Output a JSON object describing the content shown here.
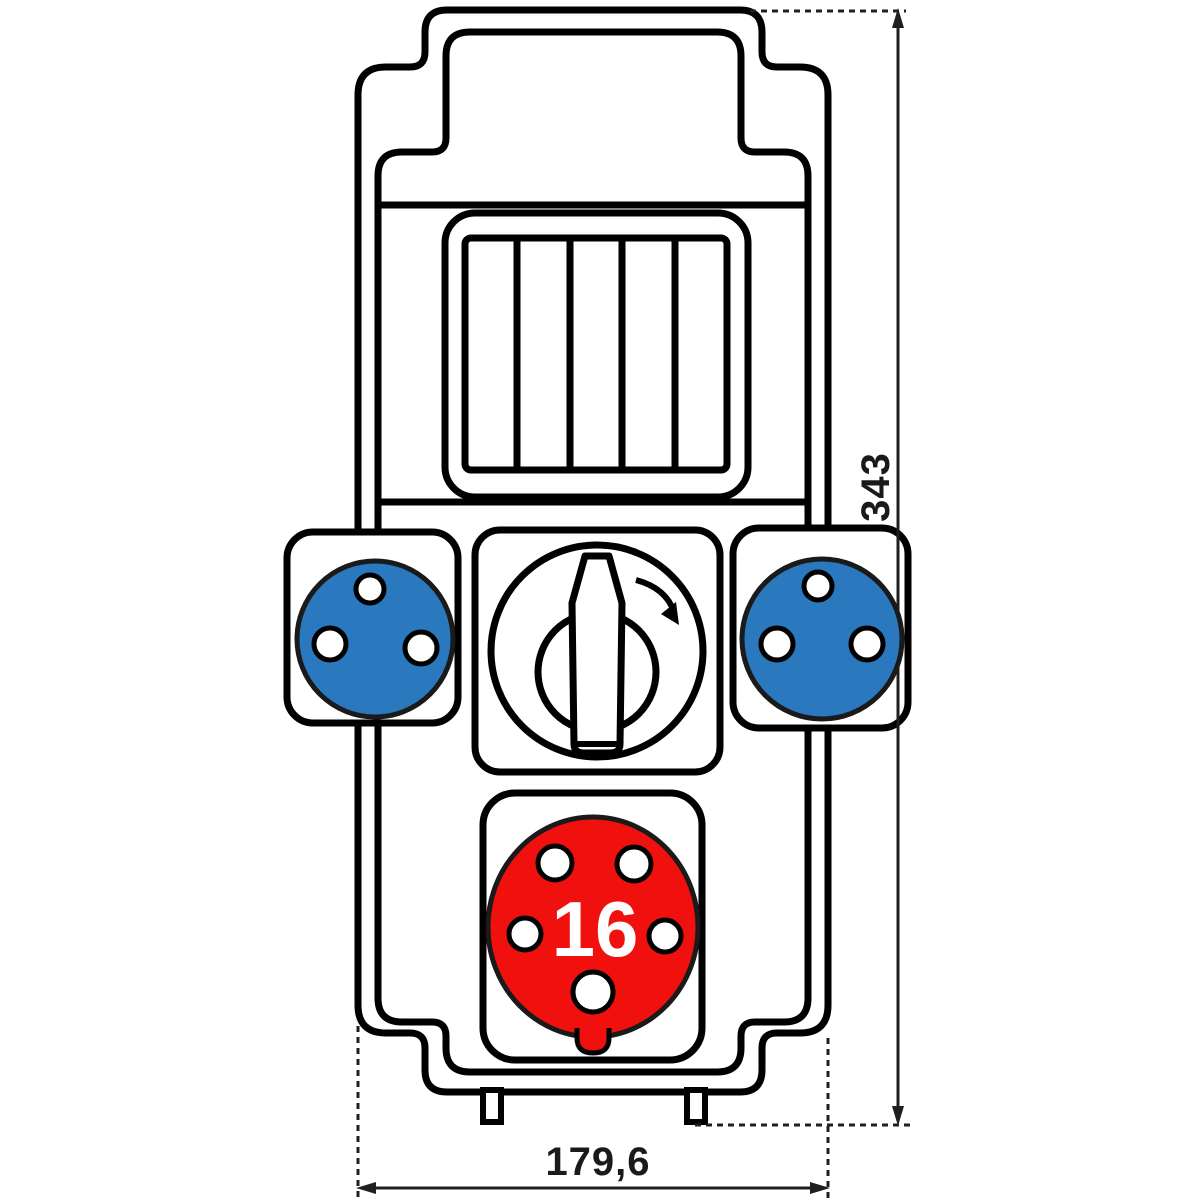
{
  "drawing": {
    "kind": "distribution-box-front-view",
    "dimensions": {
      "height_label": "343",
      "width_label": "179,6"
    },
    "cee_socket": {
      "rating_label": "16",
      "pin_holes": 5
    },
    "schuko_sockets": {
      "count": 2,
      "pin_holes_each": 3
    },
    "breaker_window": {
      "module_slots": 5
    },
    "colors": {
      "socket_blue": "#2a78be",
      "socket_red": "#f0100e",
      "outline_black": "#000000",
      "dimension_dark": "#1f1f1f",
      "hole_white": "#ffffff",
      "background": "#ffffff"
    }
  }
}
